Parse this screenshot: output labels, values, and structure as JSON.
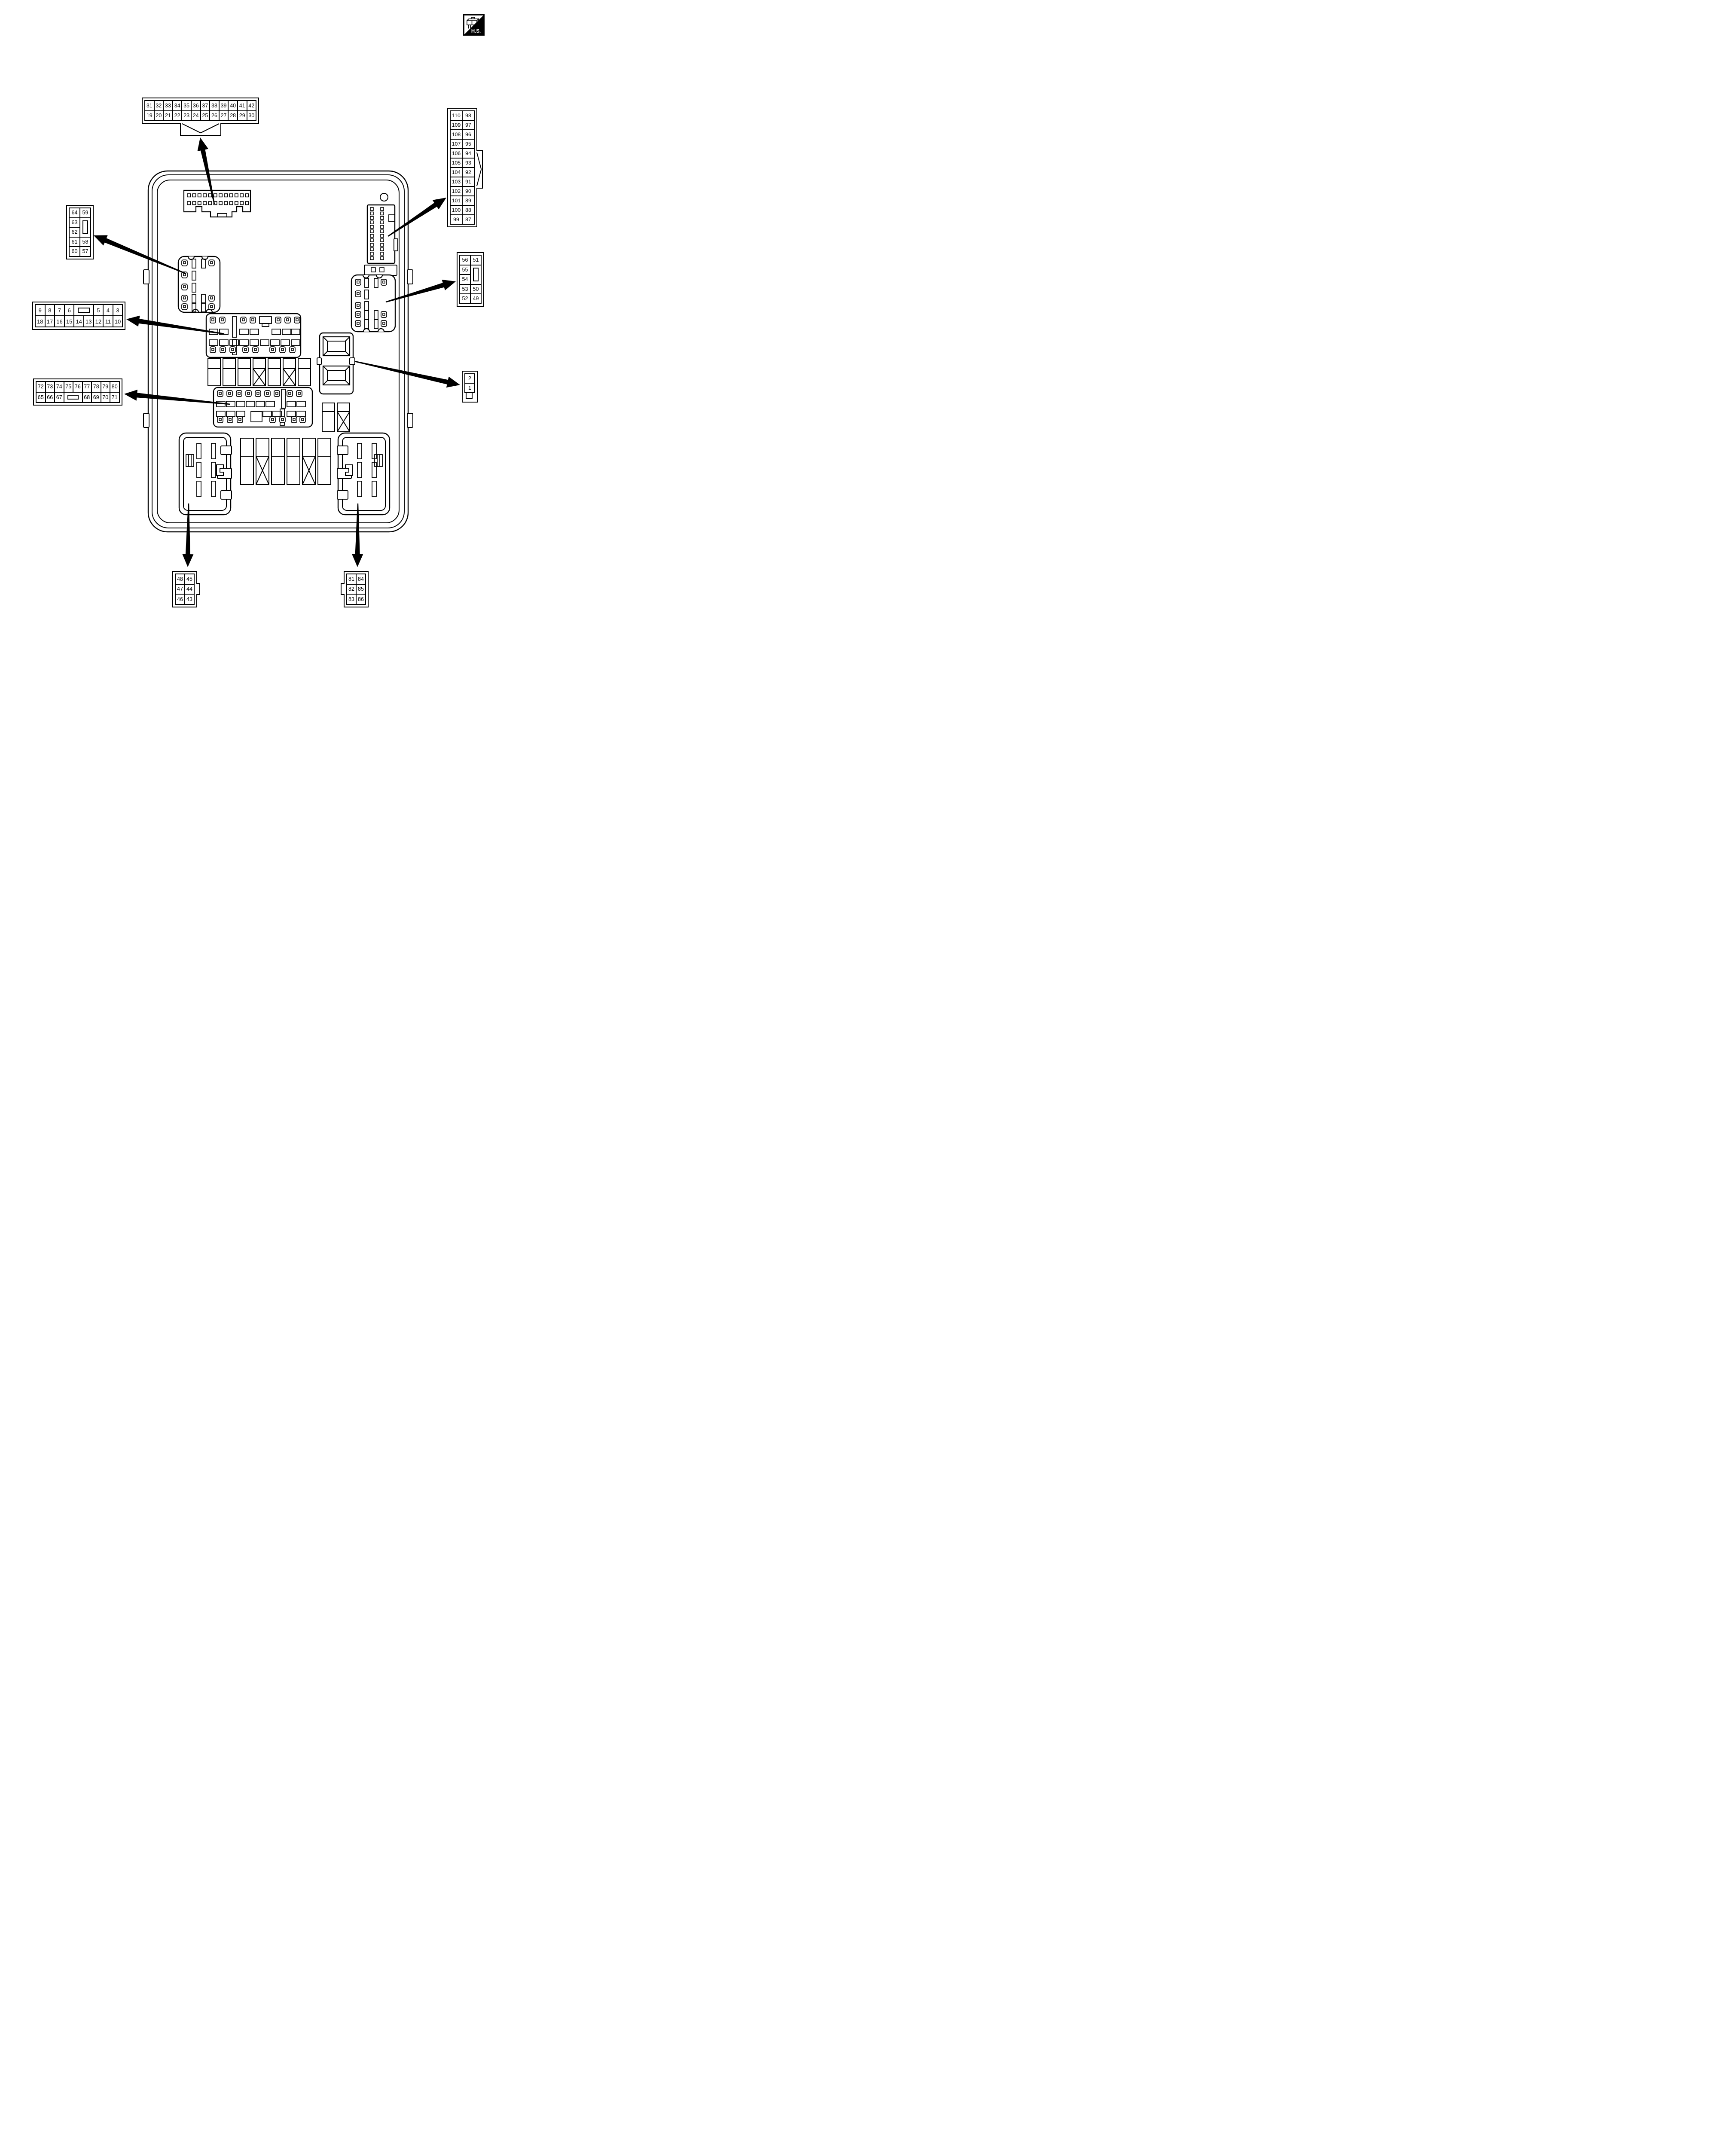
{
  "hs_badge": {
    "label": "H.S."
  },
  "tables": {
    "top": {
      "cols": 12,
      "rows": [
        [
          "31",
          "32",
          "33",
          "34",
          "35",
          "36",
          "37",
          "38",
          "39",
          "40",
          "41",
          "42"
        ],
        [
          "19",
          "20",
          "21",
          "22",
          "23",
          "24",
          "25",
          "26",
          "27",
          "28",
          "29",
          "30"
        ]
      ]
    },
    "right_top": {
      "cols": 2,
      "rows": [
        [
          "110",
          "98"
        ],
        [
          "109",
          "97"
        ],
        [
          "108",
          "96"
        ],
        [
          "107",
          "95"
        ],
        [
          "106",
          "94"
        ],
        [
          "105",
          "93"
        ],
        [
          "104",
          "92"
        ],
        [
          "103",
          "91"
        ],
        [
          "102",
          "90"
        ],
        [
          "101",
          "89"
        ],
        [
          "100",
          "88"
        ],
        [
          "99",
          "87"
        ]
      ]
    },
    "left_upper": {
      "cols": 2,
      "rows": [
        [
          "64",
          "59"
        ],
        [
          "63",
          {
            "k": "v",
            "rs": 2
          }
        ],
        [
          "62"
        ],
        [
          "61",
          "58"
        ],
        [
          "60",
          "57"
        ]
      ]
    },
    "right_mid": {
      "cols": 2,
      "rows": [
        [
          "56",
          "51"
        ],
        [
          "55",
          {
            "k": "v",
            "rs": 2
          }
        ],
        [
          "54"
        ],
        [
          "53",
          "50"
        ],
        [
          "52",
          "49"
        ]
      ]
    },
    "left_mid": {
      "cols": 9,
      "rows": [
        [
          "9",
          "8",
          "7",
          "6",
          {
            "k": "h",
            "cs": 2
          },
          "5",
          "4",
          "3"
        ],
        [
          "18",
          "17",
          "16",
          "15",
          "14",
          "13",
          "12",
          "11",
          "10"
        ]
      ]
    },
    "left_lower": {
      "cols": 9,
      "rows": [
        [
          "72",
          "73",
          "74",
          "75",
          "76",
          "77",
          "78",
          "79",
          "80"
        ],
        [
          "65",
          "66",
          "67",
          {
            "k": "h",
            "cs": 2
          },
          "68",
          "69",
          "70",
          "71"
        ]
      ]
    },
    "pair_small": {
      "cols": 1,
      "rows": [
        [
          "2"
        ],
        [
          "1"
        ]
      ]
    },
    "bottom_left": {
      "cols": 2,
      "rows": [
        [
          "48",
          "45"
        ],
        [
          "47",
          "44"
        ],
        [
          "46",
          "43"
        ]
      ]
    },
    "bottom_right": {
      "cols": 2,
      "rows": [
        [
          "81",
          "84"
        ],
        [
          "82",
          "85"
        ],
        [
          "83",
          "86"
        ]
      ]
    }
  }
}
